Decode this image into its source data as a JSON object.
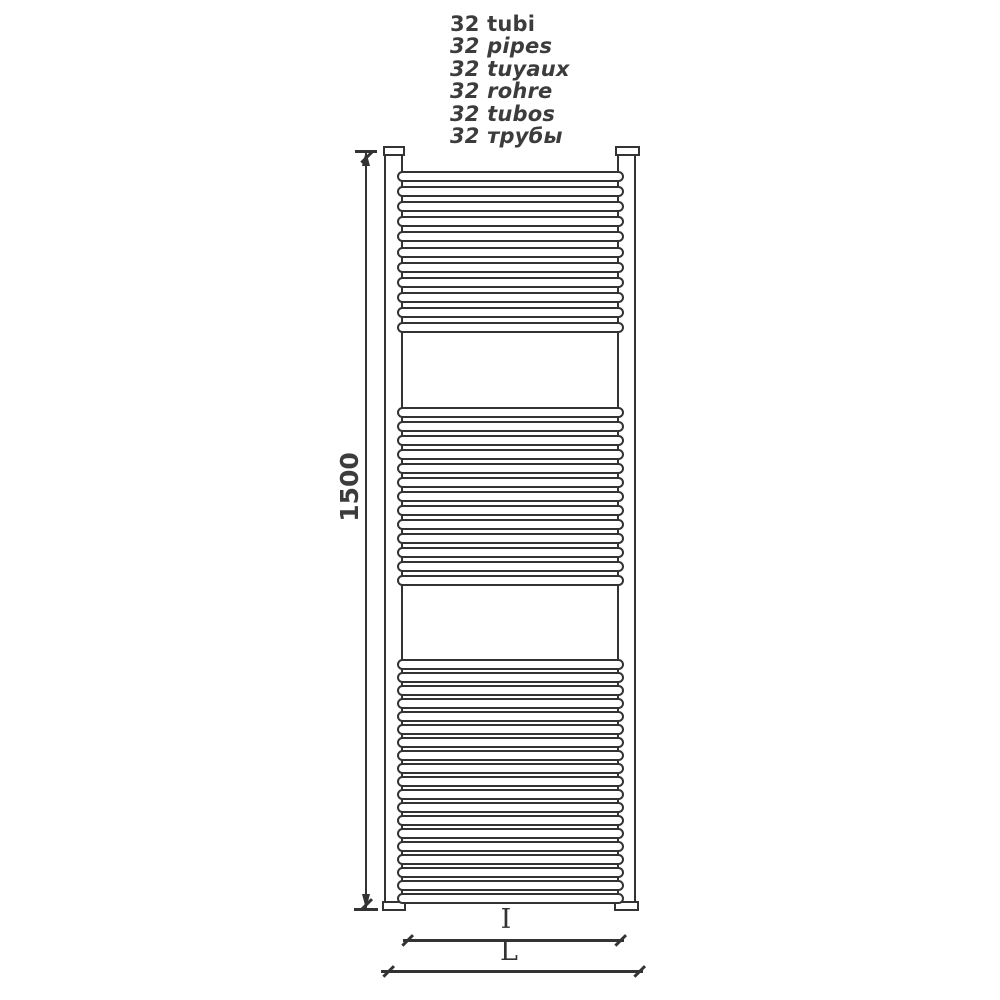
{
  "drawing": {
    "tube_count_labels": [
      {
        "text": "32 tubi",
        "italic": false
      },
      {
        "text": "32 pipes",
        "italic": true
      },
      {
        "text": "32 tuyaux",
        "italic": true
      },
      {
        "text": "32 rohre",
        "italic": true
      },
      {
        "text": "32 tubos",
        "italic": true
      },
      {
        "text": "32 трубы",
        "italic": true
      }
    ],
    "dimensions": {
      "height": "1500",
      "inner_width": "I",
      "overall_width": "L"
    },
    "radiator": {
      "type": "ladder towel radiator, front view",
      "tube_groups": [
        {
          "count": 11
        },
        {
          "count": 13
        },
        {
          "count": 19
        }
      ]
    },
    "colors": {
      "line": "#333333",
      "text": "#3c3c3c",
      "background": "#ffffff"
    }
  }
}
